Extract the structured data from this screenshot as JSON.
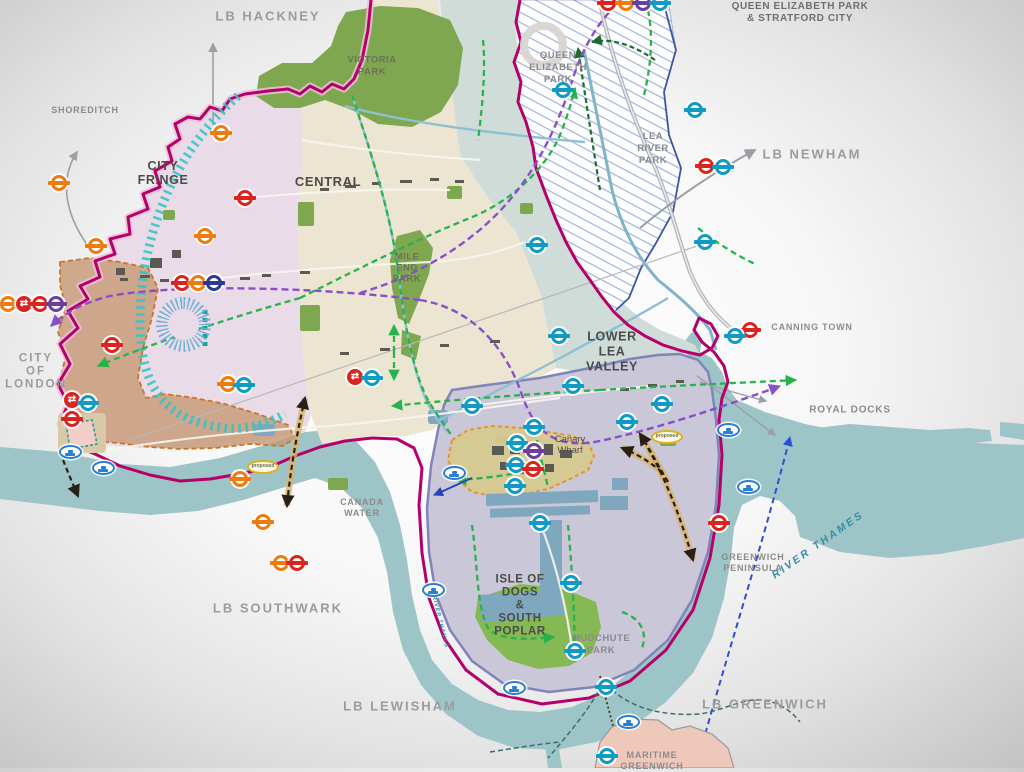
{
  "title": "Tower Hamlets area framework map",
  "labels": {
    "hackney": "LB HACKNEY",
    "newham": "LB NEWHAM",
    "southwark": "LB SOUTHWARK",
    "lewisham": "LB LEWISHAM",
    "greenwich": "LB GREENWICH",
    "shoreditch": "SHOREDITCH",
    "city_of_london": "CITY\nOF\nLONDON",
    "canning_town": "CANNING TOWN",
    "royal_docks": "ROYAL DOCKS",
    "canada_water": "CANADA\nWATER",
    "greenwich_peninsula": "GREENWICH\nPENINSULA",
    "maritime_greenwich": "MARITIME\nGREENWICH",
    "qep_stratford_title": "QUEEN ELIZABETH PARK\n& STRATFORD CITY",
    "city_fringe": "CITY\nFRINGE",
    "central": "CENTRAL",
    "lower_lea_valley": "LOWER\nLEA\nVALLEY",
    "isle_of_dogs": "ISLE OF\nDOGS\n&\nSOUTH\nPOPLAR",
    "victoria_park": "VICTORIA\nPARK",
    "mile_end_park": "MILE\nEND\nPARK",
    "queen_elizabeth_park": "QUEEN\nELIZABETH\nPARK",
    "lea_river_park": "LEA\nRIVER\nPARK",
    "mudchute_park": "MUDCHUTE\nPARK",
    "canary_wharf": "Canary\nWharf",
    "river_thames": "RIVER THAMES",
    "proposed": "proposed"
  },
  "colors": {
    "borough_boundary": "#b5006b",
    "boundary_casing": "#ecc2d8",
    "river": "#9dc4c6",
    "city_fringe_fill": "#e9dbe7",
    "central_fill": "#ece5d2",
    "lower_lea_fill": "#d0dcd8",
    "isle_of_dogs_fill": "#c9c7d8",
    "isle_of_dogs_edge": "#8084b8",
    "canary_fill": "#d7ca8e",
    "opportunity_brown": "#c79a76",
    "orange_edge": "#e8922e",
    "park_green": "#7fa74f",
    "green_route": "#28b24b",
    "dark_green_route": "#1d6e2e",
    "purple_route": "#8a4fc8",
    "teal_hatch": "#35c4c4",
    "hatch_blue": "#9fb0dc",
    "tunnel_black": "#262016",
    "tunnel_casing": "#d9b46a",
    "proposed_blue": "#2d4fd4",
    "maritime_fill": "#eec9bb"
  },
  "icon_legend": {
    "red": "London Underground station",
    "orange": "Overground station",
    "teal": "DLR / Jubilee station",
    "purple": "Elizabeth line station",
    "navy": "Underground station",
    "rail": "National Rail station",
    "riverbus": "River bus pier",
    "proposed": "Proposed pier"
  },
  "transit": {
    "roundels": [
      {
        "x": 608,
        "y": 3,
        "line": "red"
      },
      {
        "x": 626,
        "y": 3,
        "line": "orange"
      },
      {
        "x": 643,
        "y": 3,
        "line": "purple"
      },
      {
        "x": 660,
        "y": 3,
        "line": "teal"
      },
      {
        "x": 563,
        "y": 90,
        "line": "teal"
      },
      {
        "x": 695,
        "y": 110,
        "line": "teal"
      },
      {
        "x": 706,
        "y": 166,
        "line": "red"
      },
      {
        "x": 723,
        "y": 167,
        "line": "teal"
      },
      {
        "x": 705,
        "y": 242,
        "line": "teal"
      },
      {
        "x": 750,
        "y": 330,
        "line": "red"
      },
      {
        "x": 735,
        "y": 336,
        "line": "teal"
      },
      {
        "x": 8,
        "y": 304,
        "line": "orange"
      },
      {
        "x": 24,
        "y": 304,
        "line": "rail"
      },
      {
        "x": 40,
        "y": 304,
        "line": "red"
      },
      {
        "x": 56,
        "y": 304,
        "line": "purple"
      },
      {
        "x": 59,
        "y": 183,
        "line": "orange"
      },
      {
        "x": 96,
        "y": 246,
        "line": "orange"
      },
      {
        "x": 112,
        "y": 345,
        "line": "red"
      },
      {
        "x": 221,
        "y": 133,
        "line": "orange"
      },
      {
        "x": 245,
        "y": 198,
        "line": "red"
      },
      {
        "x": 205,
        "y": 236,
        "line": "orange"
      },
      {
        "x": 182,
        "y": 283,
        "line": "red"
      },
      {
        "x": 198,
        "y": 283,
        "line": "orange"
      },
      {
        "x": 214,
        "y": 283,
        "line": "navy"
      },
      {
        "x": 355,
        "y": 377,
        "line": "rail"
      },
      {
        "x": 372,
        "y": 378,
        "line": "teal"
      },
      {
        "x": 228,
        "y": 384,
        "line": "orange"
      },
      {
        "x": 244,
        "y": 385,
        "line": "teal"
      },
      {
        "x": 72,
        "y": 400,
        "line": "rail"
      },
      {
        "x": 88,
        "y": 403,
        "line": "teal"
      },
      {
        "x": 72,
        "y": 419,
        "line": "red"
      },
      {
        "x": 240,
        "y": 479,
        "line": "orange"
      },
      {
        "x": 263,
        "y": 522,
        "line": "orange"
      },
      {
        "x": 281,
        "y": 563,
        "line": "orange"
      },
      {
        "x": 297,
        "y": 563,
        "line": "red"
      },
      {
        "x": 537,
        "y": 245,
        "line": "teal"
      },
      {
        "x": 559,
        "y": 336,
        "line": "teal"
      },
      {
        "x": 573,
        "y": 386,
        "line": "teal"
      },
      {
        "x": 472,
        "y": 406,
        "line": "teal"
      },
      {
        "x": 534,
        "y": 427,
        "line": "teal"
      },
      {
        "x": 517,
        "y": 443,
        "line": "teal"
      },
      {
        "x": 534,
        "y": 451,
        "line": "purple"
      },
      {
        "x": 516,
        "y": 465,
        "line": "teal"
      },
      {
        "x": 533,
        "y": 469,
        "line": "red"
      },
      {
        "x": 515,
        "y": 486,
        "line": "teal"
      },
      {
        "x": 662,
        "y": 404,
        "line": "teal"
      },
      {
        "x": 627,
        "y": 422,
        "line": "teal"
      },
      {
        "x": 540,
        "y": 523,
        "line": "teal"
      },
      {
        "x": 571,
        "y": 583,
        "line": "teal"
      },
      {
        "x": 575,
        "y": 651,
        "line": "teal"
      },
      {
        "x": 606,
        "y": 687,
        "line": "teal"
      },
      {
        "x": 607,
        "y": 756,
        "line": "teal"
      },
      {
        "x": 719,
        "y": 523,
        "line": "red"
      }
    ],
    "riverbus_stops": [
      {
        "x": 70,
        "y": 452
      },
      {
        "x": 103,
        "y": 468
      },
      {
        "x": 454,
        "y": 473
      },
      {
        "x": 433,
        "y": 590
      },
      {
        "x": 514,
        "y": 688
      },
      {
        "x": 628,
        "y": 722
      },
      {
        "x": 728,
        "y": 430
      },
      {
        "x": 748,
        "y": 487
      }
    ],
    "proposed_piers": [
      {
        "x": 263,
        "y": 467
      },
      {
        "x": 667,
        "y": 437
      }
    ]
  }
}
